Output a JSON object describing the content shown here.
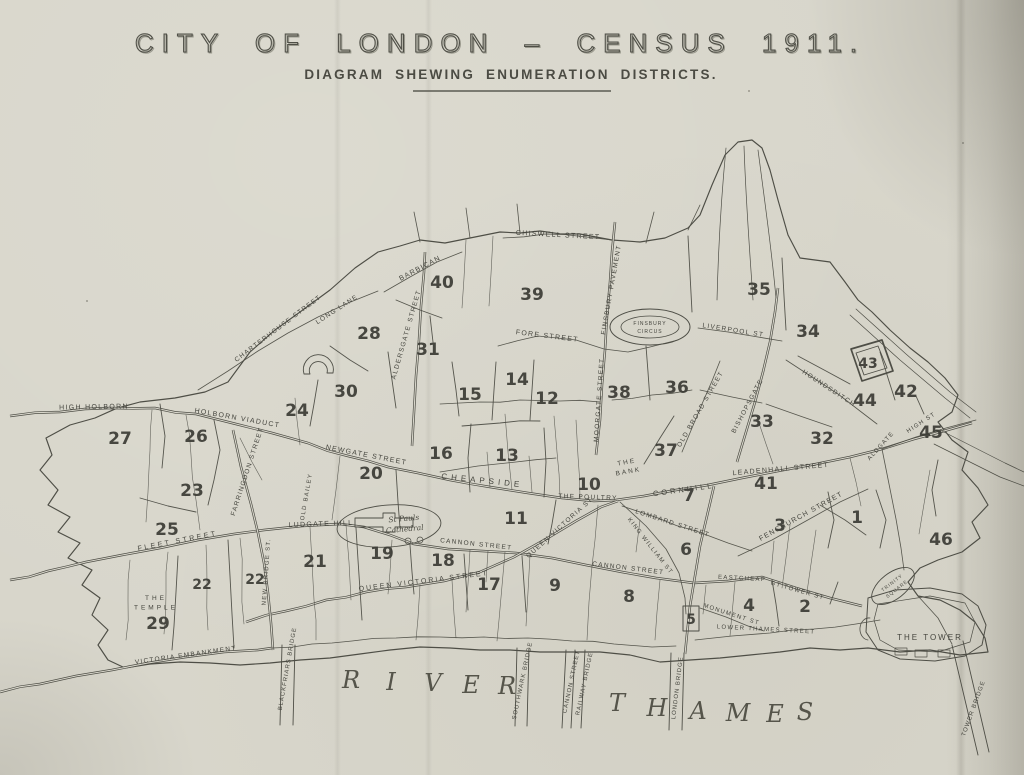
{
  "page": {
    "paper_color": "#d8d6cb",
    "ink_color": "#4e4e46"
  },
  "header": {
    "title": "CITY OF LONDON – CENSUS 1911.",
    "subtitle": "DIAGRAM SHEWING ENUMERATION DISTRICTS."
  },
  "map": {
    "districts": [
      {
        "n": "1",
        "x": 857,
        "y": 517
      },
      {
        "n": "2",
        "x": 805,
        "y": 606
      },
      {
        "n": "3",
        "x": 780,
        "y": 525
      },
      {
        "n": "4",
        "x": 749,
        "y": 605
      },
      {
        "n": "5",
        "x": 691,
        "y": 618,
        "small": true
      },
      {
        "n": "6",
        "x": 686,
        "y": 549
      },
      {
        "n": "7",
        "x": 689,
        "y": 495
      },
      {
        "n": "8",
        "x": 629,
        "y": 596
      },
      {
        "n": "9",
        "x": 555,
        "y": 585
      },
      {
        "n": "10",
        "x": 589,
        "y": 484
      },
      {
        "n": "11",
        "x": 516,
        "y": 518
      },
      {
        "n": "12",
        "x": 547,
        "y": 398
      },
      {
        "n": "13",
        "x": 507,
        "y": 455
      },
      {
        "n": "14",
        "x": 517,
        "y": 379
      },
      {
        "n": "15",
        "x": 470,
        "y": 394
      },
      {
        "n": "16",
        "x": 441,
        "y": 453
      },
      {
        "n": "17",
        "x": 489,
        "y": 584
      },
      {
        "n": "18",
        "x": 443,
        "y": 560
      },
      {
        "n": "19",
        "x": 382,
        "y": 553
      },
      {
        "n": "20",
        "x": 371,
        "y": 473
      },
      {
        "n": "21",
        "x": 315,
        "y": 561
      },
      {
        "n": "22",
        "x": 202,
        "y": 583,
        "small": true
      },
      {
        "n": "22",
        "x": 255,
        "y": 578,
        "small": true
      },
      {
        "n": "23",
        "x": 192,
        "y": 490
      },
      {
        "n": "24",
        "x": 297,
        "y": 410
      },
      {
        "n": "25",
        "x": 167,
        "y": 529
      },
      {
        "n": "26",
        "x": 196,
        "y": 436
      },
      {
        "n": "27",
        "x": 120,
        "y": 438
      },
      {
        "n": "28",
        "x": 369,
        "y": 333
      },
      {
        "n": "29",
        "x": 158,
        "y": 623
      },
      {
        "n": "30",
        "x": 346,
        "y": 391
      },
      {
        "n": "31",
        "x": 428,
        "y": 349
      },
      {
        "n": "32",
        "x": 822,
        "y": 438
      },
      {
        "n": "33",
        "x": 762,
        "y": 421
      },
      {
        "n": "34",
        "x": 808,
        "y": 331
      },
      {
        "n": "35",
        "x": 759,
        "y": 289
      },
      {
        "n": "36",
        "x": 677,
        "y": 387
      },
      {
        "n": "37",
        "x": 666,
        "y": 450
      },
      {
        "n": "38",
        "x": 619,
        "y": 392
      },
      {
        "n": "39",
        "x": 532,
        "y": 294
      },
      {
        "n": "40",
        "x": 442,
        "y": 282
      },
      {
        "n": "41",
        "x": 766,
        "y": 483
      },
      {
        "n": "42",
        "x": 906,
        "y": 391
      },
      {
        "n": "43",
        "x": 868,
        "y": 362,
        "small": true
      },
      {
        "n": "44",
        "x": 865,
        "y": 400
      },
      {
        "n": "45",
        "x": 931,
        "y": 432
      },
      {
        "n": "46",
        "x": 941,
        "y": 539
      }
    ],
    "streets": [
      {
        "label": "CHISWELL STREET",
        "x": 558,
        "y": 237,
        "r": 3,
        "s": 7
      },
      {
        "label": "BARBICAN",
        "x": 421,
        "y": 270,
        "r": -28,
        "s": 7
      },
      {
        "label": "ALDERSGATE STREET",
        "x": 408,
        "y": 335,
        "r": -74,
        "s": 6.5
      },
      {
        "label": "LONG LANE",
        "x": 338,
        "y": 311,
        "r": -33,
        "s": 6.5
      },
      {
        "label": "CHARTERHOUSE STREET",
        "x": 279,
        "y": 330,
        "r": -37,
        "s": 6.5
      },
      {
        "label": "FORE STREET",
        "x": 547,
        "y": 338,
        "r": 7,
        "s": 7
      },
      {
        "label": "FINSBURY PAVEMENT",
        "x": 613,
        "y": 290,
        "r": -80,
        "s": 6.5
      },
      {
        "label": "MOORGATE STREET",
        "x": 601,
        "y": 400,
        "r": -86,
        "s": 6.5
      },
      {
        "label": "LIVERPOOL ST",
        "x": 733,
        "y": 332,
        "r": 9,
        "s": 6.5
      },
      {
        "label": "HOUNDSDITCH",
        "x": 828,
        "y": 390,
        "r": 33,
        "s": 6.5
      },
      {
        "label": "BISHOPSGATE",
        "x": 749,
        "y": 407,
        "r": -62,
        "s": 6.5
      },
      {
        "label": "OLD BROAD STREET",
        "x": 702,
        "y": 410,
        "r": -60,
        "s": 6.5
      },
      {
        "label": "HIGH HOLBORN",
        "x": 94,
        "y": 409,
        "r": -1,
        "s": 7
      },
      {
        "label": "HOLBORN VIADUCT",
        "x": 237,
        "y": 420,
        "r": 10,
        "s": 7
      },
      {
        "label": "NEWGATE STREET",
        "x": 366,
        "y": 457,
        "r": 11,
        "s": 7
      },
      {
        "label": "FARRINGDON STREET",
        "x": 249,
        "y": 472,
        "r": -72,
        "s": 6.5
      },
      {
        "label": "OLD BAILEY",
        "x": 308,
        "y": 497,
        "r": -80,
        "s": 6
      },
      {
        "label": "LUDGATE HILL",
        "x": 321,
        "y": 526,
        "r": -2,
        "s": 7
      },
      {
        "label": "FLEET STREET",
        "x": 178,
        "y": 543,
        "r": -11,
        "s": 7,
        "ls": 2.5
      },
      {
        "label": "NEW BRIDGE ST.",
        "x": 268,
        "y": 572,
        "r": -86,
        "s": 6
      },
      {
        "label": "CHEAPSIDE",
        "x": 482,
        "y": 483,
        "r": 6,
        "s": 8,
        "ls": 4
      },
      {
        "label": "THE POULTRY",
        "x": 588,
        "y": 499,
        "r": 2,
        "s": 6.5
      },
      {
        "label": "CORNHILL",
        "x": 684,
        "y": 492,
        "r": -8,
        "s": 7.5,
        "ls": 3
      },
      {
        "label": "LEADENHALL STREET",
        "x": 781,
        "y": 471,
        "r": -5,
        "s": 7
      },
      {
        "label": "LOMBARD STREET",
        "x": 672,
        "y": 525,
        "r": 18,
        "s": 6.5
      },
      {
        "label": "KING WILLIAM ST",
        "x": 649,
        "y": 547,
        "r": 52,
        "s": 6
      },
      {
        "label": "QUEEN VICTORIA ST",
        "x": 561,
        "y": 529,
        "r": -42,
        "s": 6.5
      },
      {
        "label": "CANNON STREET",
        "x": 476,
        "y": 546,
        "r": 6,
        "s": 6.5
      },
      {
        "label": "CANNON STREET",
        "x": 628,
        "y": 570,
        "r": 7,
        "s": 6.5
      },
      {
        "label": "QUEEN VICTORIA STREET",
        "x": 424,
        "y": 583,
        "r": -7,
        "s": 7,
        "ls": 2
      },
      {
        "label": "FENCHURCH STREET",
        "x": 802,
        "y": 518,
        "r": -29,
        "s": 7
      },
      {
        "label": "EASTCHEAP",
        "x": 742,
        "y": 580,
        "r": 3,
        "s": 6
      },
      {
        "label": "GT TOWER ST",
        "x": 797,
        "y": 592,
        "r": 16,
        "s": 6
      },
      {
        "label": "MONUMENT ST",
        "x": 731,
        "y": 616,
        "r": 18,
        "s": 6
      },
      {
        "label": "LOWER THAMES STREET",
        "x": 766,
        "y": 631,
        "r": 3,
        "s": 6
      },
      {
        "label": "VICTORIA EMBANKMENT",
        "x": 186,
        "y": 657,
        "r": -8,
        "s": 6.5
      },
      {
        "label": "ALDGATE",
        "x": 882,
        "y": 447,
        "r": -48,
        "s": 6
      },
      {
        "label": "HIGH ST",
        "x": 922,
        "y": 424,
        "r": -33,
        "s": 6
      }
    ],
    "bridges": [
      {
        "label": "BLACKFRIARS BRIDGE",
        "x": 289,
        "y": 669,
        "r": -80
      },
      {
        "label": "SOUTHWARK BRIDGE",
        "x": 524,
        "y": 681,
        "r": -78
      },
      {
        "label": "CANNON STREET",
        "x": 573,
        "y": 682,
        "r": -78
      },
      {
        "label": "RAILWAY BRIDGE",
        "x": 586,
        "y": 684,
        "r": -78
      },
      {
        "label": "LONDON BRIDGE",
        "x": 679,
        "y": 688,
        "r": -83
      },
      {
        "label": "TOWER BRIDGE",
        "x": 975,
        "y": 709,
        "r": -70
      }
    ],
    "places": [
      {
        "id": "the-bank",
        "lines": [
          "THE",
          "BANK"
        ],
        "x": 627,
        "y": 464,
        "r": -10,
        "s": 6.5,
        "ls": 2
      },
      {
        "id": "finsbury-circus",
        "lines": [
          "FINSBURY",
          "CIRCUS"
        ],
        "x": 650,
        "y": 325,
        "r": 0,
        "s": 5,
        "ls": 1
      },
      {
        "id": "trinity-square",
        "lines": [
          "TRINITY",
          "SQUARE"
        ],
        "x": 893,
        "y": 584,
        "r": -38,
        "s": 4.8,
        "ls": 1
      },
      {
        "id": "the-temple",
        "lines": [
          "THE",
          "TEMPLE"
        ],
        "x": 156,
        "y": 600,
        "r": 0,
        "s": 6.5,
        "ls": 3
      },
      {
        "id": "the-tower",
        "lines": [
          "THE TOWER"
        ],
        "x": 930,
        "y": 640,
        "r": 0,
        "s": 8,
        "ls": 2
      },
      {
        "id": "st-pauls-cathedral",
        "lines": [
          "St Pauls",
          "Cathedral"
        ],
        "x": 404,
        "y": 521,
        "r": -5,
        "s": 7.5,
        "ls": 0,
        "serif": true
      }
    ],
    "river": {
      "letters": [
        {
          "ch": "R",
          "x": 351,
          "y": 688
        },
        {
          "ch": "I",
          "x": 391,
          "y": 690
        },
        {
          "ch": "V",
          "x": 433,
          "y": 691
        },
        {
          "ch": "E",
          "x": 471,
          "y": 693
        },
        {
          "ch": "R",
          "x": 507,
          "y": 694
        },
        {
          "ch": "T",
          "x": 617,
          "y": 711
        },
        {
          "ch": "H",
          "x": 657,
          "y": 716
        },
        {
          "ch": "A",
          "x": 698,
          "y": 719
        },
        {
          "ch": "M",
          "x": 738,
          "y": 721
        },
        {
          "ch": "E",
          "x": 775,
          "y": 722
        },
        {
          "ch": "S",
          "x": 805,
          "y": 720
        }
      ]
    }
  }
}
